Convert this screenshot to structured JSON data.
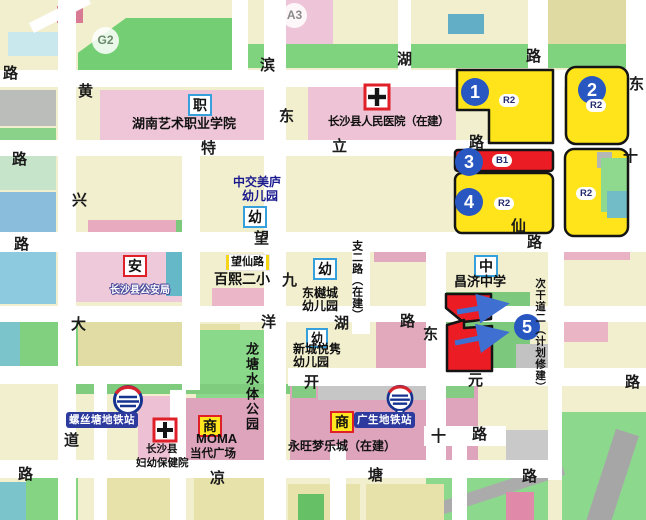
{
  "colors": {
    "zone_yellow": "#ffe41c",
    "zone_red": "#ec1c24",
    "marker_blue": "#2857c2",
    "metro_blue": "#2d3a9e",
    "badge_blue_border": "#35a0dc",
    "badge_red_border": "#e02028",
    "road_white": "#ffffff",
    "park_green": "#8ad88a",
    "institution_pink": "#efc6d8"
  },
  "area_codes": {
    "g2": "G2",
    "a3": "A3"
  },
  "markers": {
    "m1": "1",
    "m2": "2",
    "m3": "3",
    "m4": "4",
    "m5": "5"
  },
  "zone_codes": {
    "z1": "R2",
    "z2": "R2",
    "z3": "B1",
    "z4": "R2",
    "z5": "R2"
  },
  "badges": {
    "vocational": "职",
    "kindergarten": "幼",
    "police": "安",
    "middle_school": "中",
    "commerce": "商"
  },
  "pois": {
    "art_college": "湖南艺术职业学院",
    "county_hospital": "长沙县人民医院（在建）",
    "zhongjiao_kg_1": "中交美庐",
    "zhongjiao_kg_2": "幼儿园",
    "wangxian_road": "望仙路",
    "baixi_school": "百熙二小",
    "police_bureau": "长沙县公安局",
    "dongyue_kg_1": "东樾城",
    "dongyue_kg_2": "幼儿园",
    "xincheng_kg_1": "新城悦隽",
    "xincheng_kg_2": "幼儿园",
    "changji_school": "昌济中学",
    "longtang_park": "龙塘水体公园",
    "luositang_station": "螺丝塘地铁站",
    "guangsheng_station": "广生地铁站",
    "maternity_hospital_1": "长沙县",
    "maternity_hospital_2": "妇幼保健院",
    "moma_1": "MOMA",
    "moma_2": "当代广场",
    "aeon_mall": "永旺梦乐城（在建）",
    "secondary_road": "次干道二（计划修建）",
    "zhier_road": "支二路（在建）"
  },
  "roads": [
    "路",
    "黄",
    "滨",
    "湖",
    "路",
    "东",
    "东",
    "特",
    "立",
    "路",
    "十",
    "路",
    "兴",
    "路",
    "望",
    "仙",
    "路",
    "九",
    "洋",
    "湖",
    "路",
    "东",
    "大",
    "开",
    "元",
    "路",
    "道",
    "十",
    "路",
    "凉",
    "塘",
    "路",
    "路"
  ],
  "icons": {
    "metro": "changsha-metro-logo",
    "hospital": "hospital-cross",
    "arrow": "blue-flow-arrow"
  }
}
